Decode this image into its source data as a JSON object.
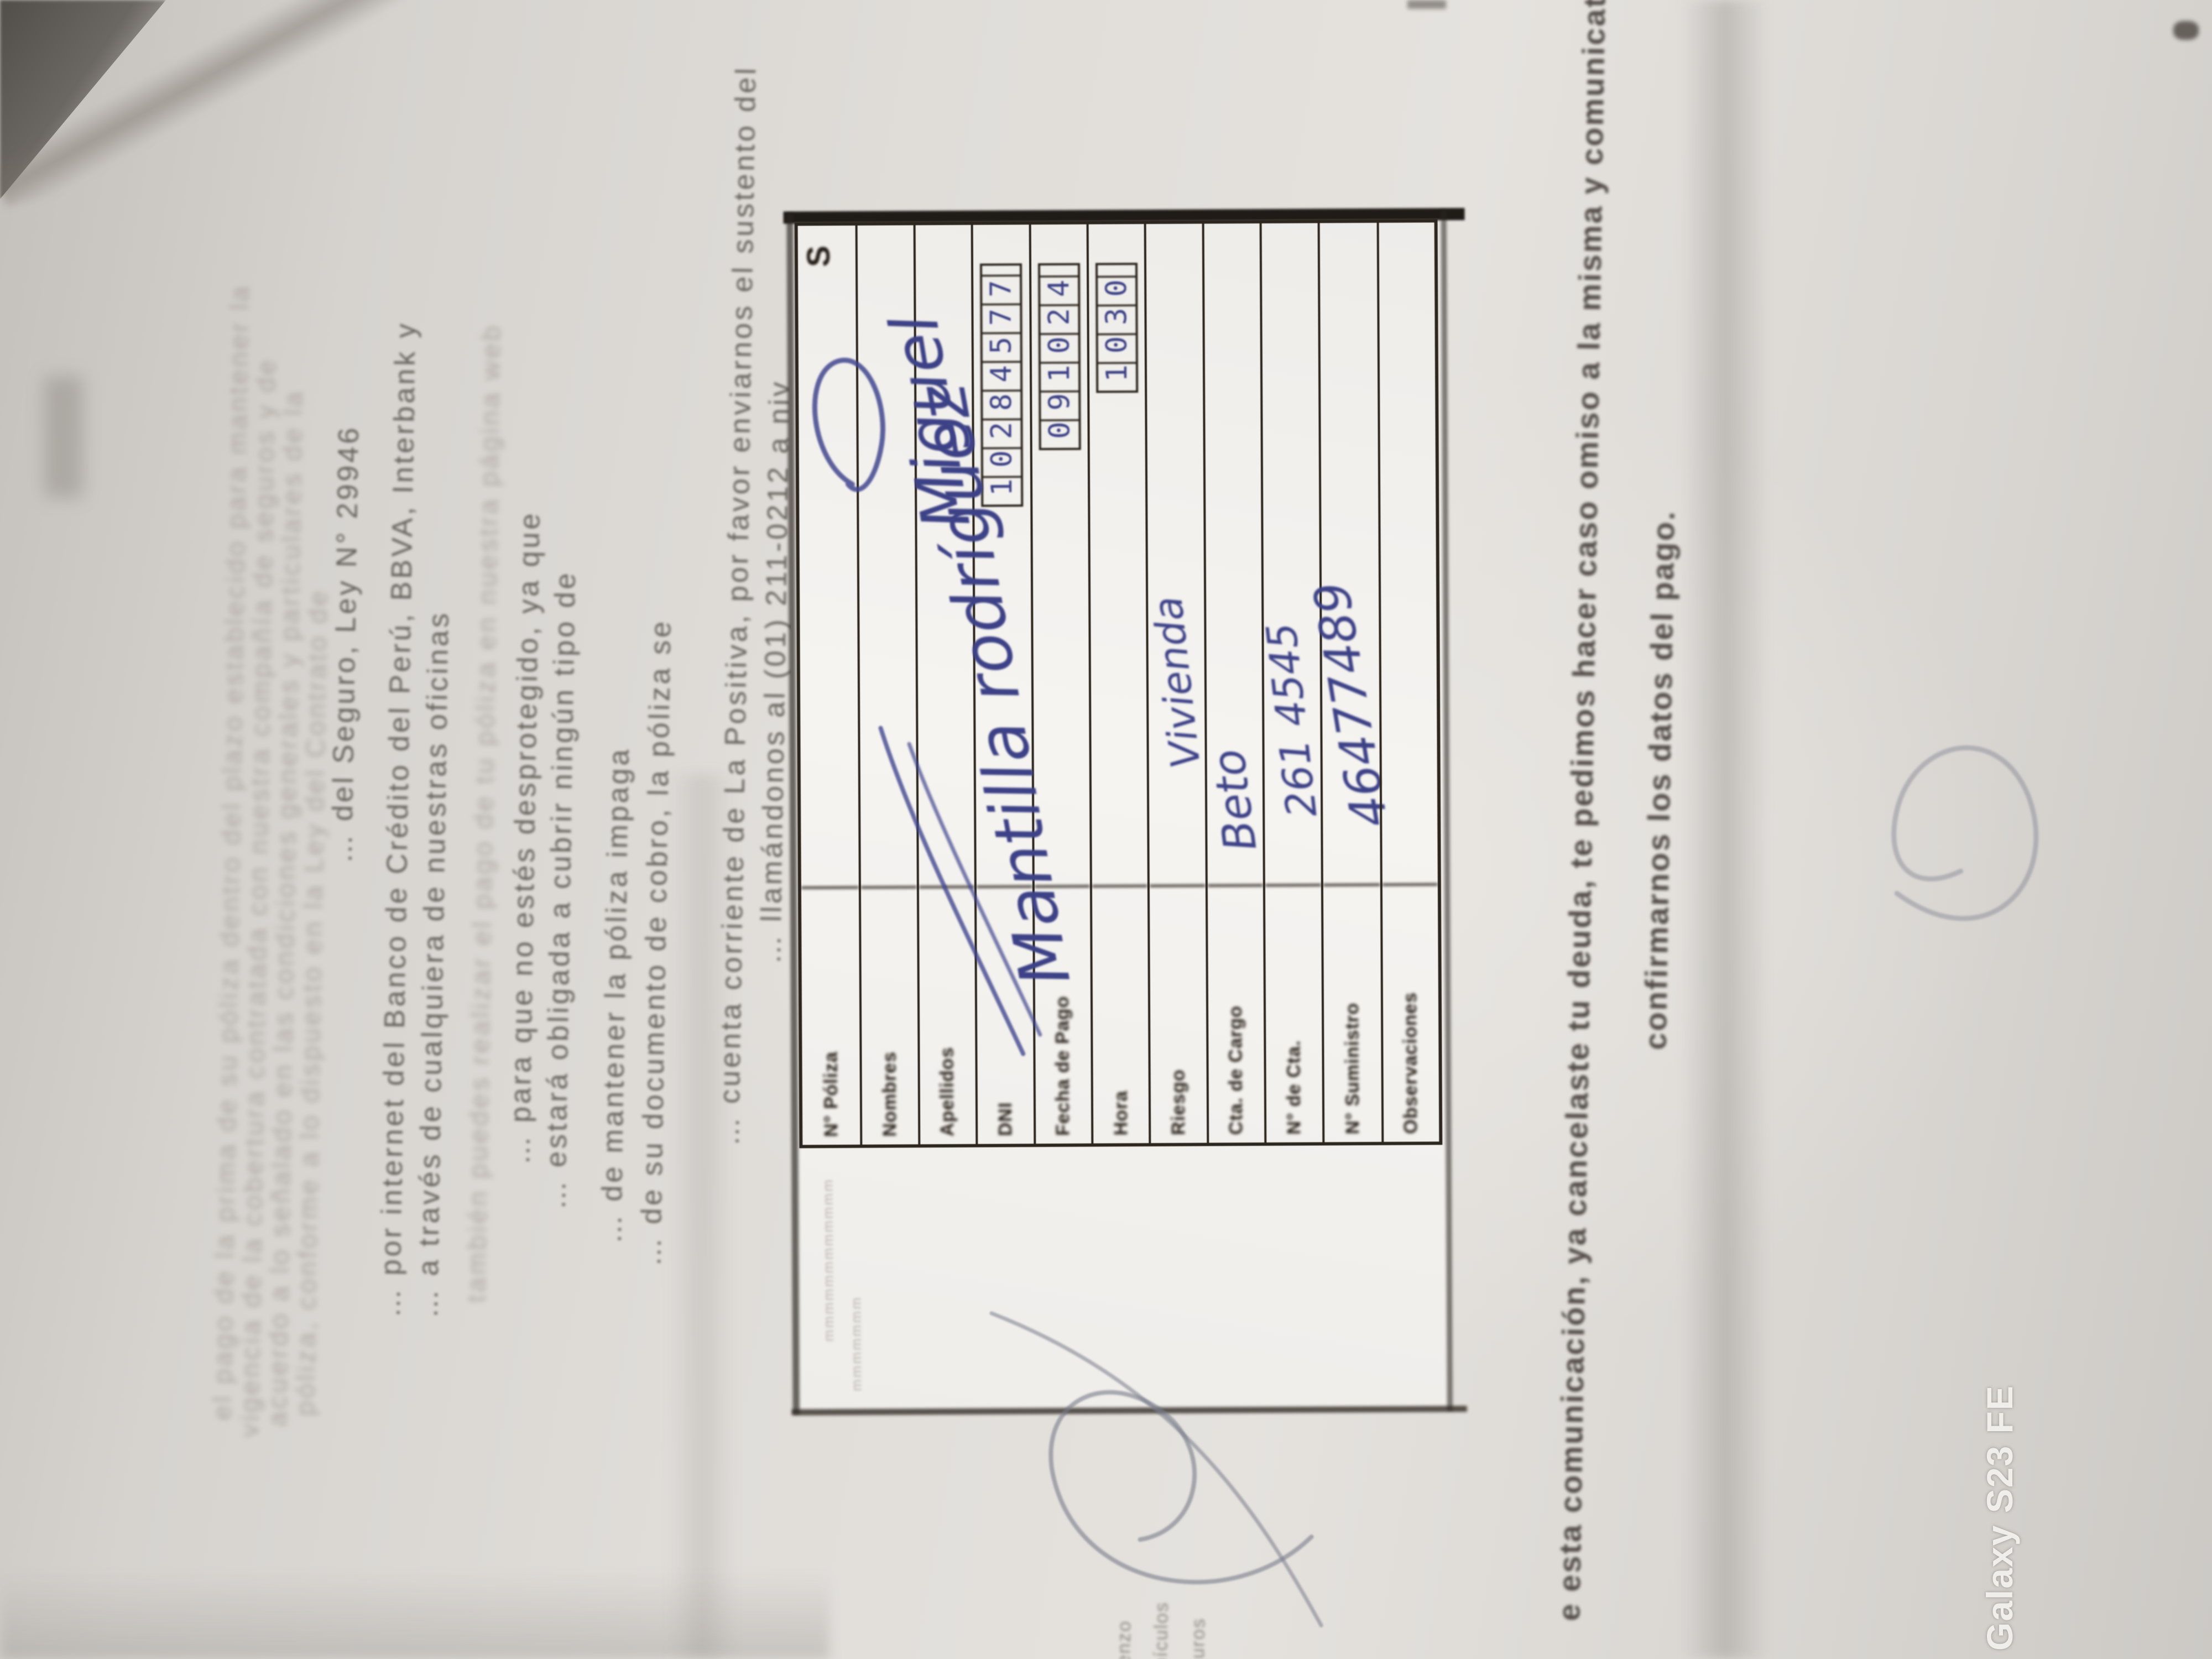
{
  "photo": {
    "watermark_text": "Galaxy S23 FE",
    "paper_base": "#dcd9d5",
    "surface_dark": "#57534e",
    "ink_blue": "#3d4287",
    "print_gray": "#716d68"
  },
  "letter": {
    "para_top": {
      "l1": "el pago de la prima de su póliza dentro del plazo establecido para mantener la",
      "l2": "vigencia de la cobertura contratada con nuestra compañía de seguros y de",
      "l3": "acuerdo a lo señalado en las condiciones generales y particulares de la",
      "l4": "póliza, conforme a lo dispuesto en la Ley del Contrato de",
      "l5": "… del Seguro, Ley N° 29946"
    },
    "para_mid": {
      "l1": "… por internet del Banco de Crédito del Perú, BBVA, Interbank y",
      "l2": "… a través de cualquiera de nuestras oficinas",
      "l3": "también puedes realizar el pago de tu póliza en nuestra página web",
      "l4": "… para que no estés desprotegido, ya que",
      "l5": "… estará obligada a cubrir ningún tipo de"
    },
    "para_low": {
      "l1": "… de mantener la póliza impaga",
      "l2": "… de su documento de cobro, la póliza se",
      "l3": "… cuenta corriente de La Positiva, por favor enviarnos el sustento del",
      "l4": "… llamándonos al (01) 211-0212 a niv"
    },
    "footer": {
      "l1": "e esta comunicación, ya cancelaste tu deuda, te pedimos hacer caso omiso a la misma y comunicate al (01) 21",
      "l2": "confirmarnos los datos del pago."
    },
    "signature_block": {
      "l1": "Matienzo",
      "l2": "de Vehículos",
      "l3": "Seguros"
    }
  },
  "slip": {
    "faint_l1": "mmmmmmmmmmmm",
    "faint_l2": "mmmmmmm",
    "corner_mark": "S",
    "rows": [
      {
        "label": "N° Póliza",
        "value": ""
      },
      {
        "label": "Nombres",
        "value": ""
      },
      {
        "label": "Apellidos",
        "value": ""
      },
      {
        "label": "DNI",
        "value": "10284577"
      },
      {
        "label": "Fecha de Pago",
        "value": "091024"
      },
      {
        "label": "Hora",
        "value": "1030"
      },
      {
        "label": "Riesgo",
        "value": "Vivienda"
      },
      {
        "label": "Cta. de Cargo",
        "value": "Beto"
      },
      {
        "label": "N° de Cta.",
        "value": "261 4545"
      },
      {
        "label": "N° Suministro",
        "value": "46477489"
      },
      {
        "label": "Observaciones",
        "value": ""
      }
    ],
    "handwriting": {
      "name1": "Miguel",
      "name2": "Mantilla rodríguez"
    }
  }
}
